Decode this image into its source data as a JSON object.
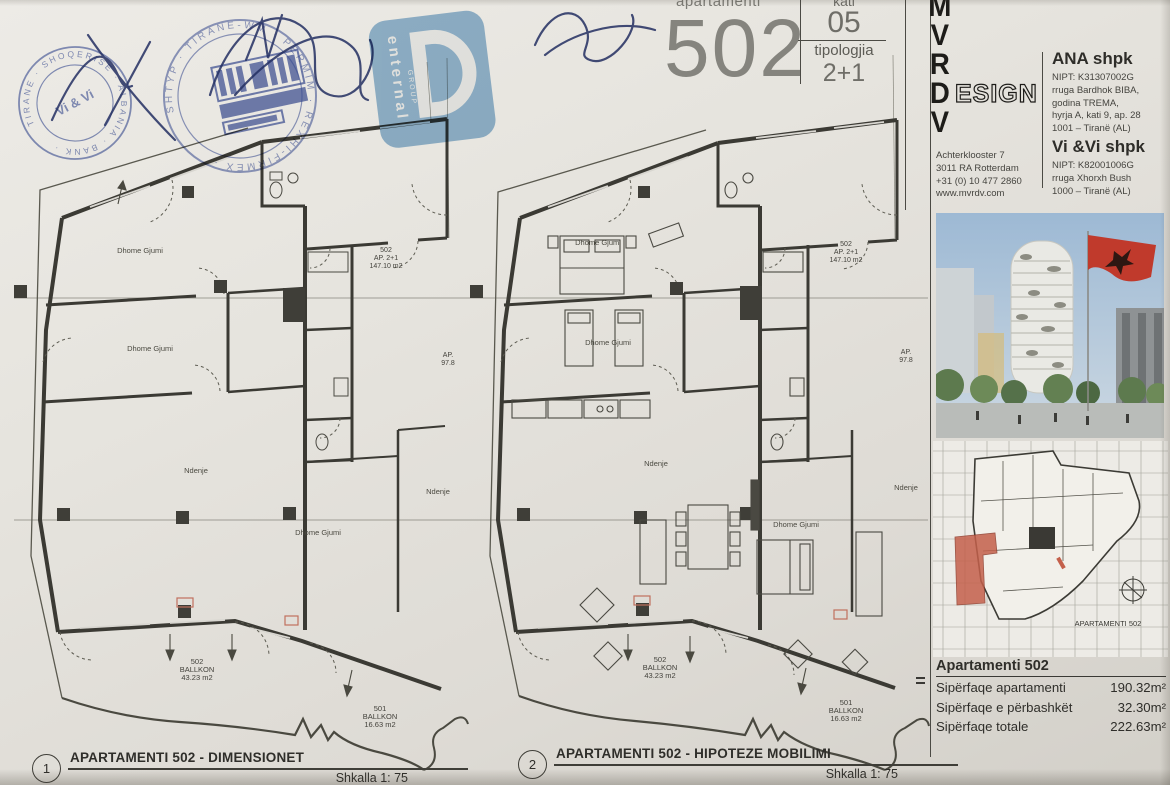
{
  "header": {
    "apartamenti_label": "apartamenti",
    "apartment_number": "502",
    "kati_label": "kati",
    "kati_value": "05",
    "tipologjia_label": "tipologjia",
    "tipologjia_value": "2+1"
  },
  "stamps": {
    "enternal_name": "enternal",
    "enternal_group": "GROUP",
    "vivi_ring_text": "TIRANE · SHOQERISE · ALBANIA · BANK ·",
    "vivi_center_text": "Vi & Vi",
    "round_ring_text": "SHTYP · TIRANE-WM · PERMIM · REXHI-FIRMEX ·"
  },
  "mvrdv": {
    "letters": [
      "M",
      "V",
      "R",
      "D",
      "V"
    ],
    "design_suffix": "ESIGN",
    "address": [
      "Achterklooster 7",
      "3011 RA Rotterdam",
      "+31 (0) 10 477 2860",
      "www.mvrdv.com"
    ]
  },
  "contacts": {
    "ana_name": "ANA shpk",
    "ana_lines": [
      "NIPT: K31307002G",
      "rruga Bardhok BIBA,",
      "godina TREMA,",
      "hyrja A, kati 9, ap. 28",
      "1001 – Tiranë (AL)"
    ],
    "vivi_name": "Vi &Vi shpk",
    "vivi_lines": [
      "NIPT: K82001006G",
      "rruga Xhorxh Bush",
      "1000 – Tiranë (AL)"
    ]
  },
  "plans": {
    "rooms": {
      "bedroom": "Dhome Gjumi",
      "living": "Ndenje"
    },
    "unit_tag": {
      "number": "502",
      "type": "AP. 2+1",
      "area": "147.10 m2"
    },
    "ap_small": {
      "label": "AP.",
      "area": "97.8"
    },
    "balcony_502": {
      "number": "502",
      "label": "BALLKON",
      "area": "43.23 m2"
    },
    "balcony_501": {
      "number": "501",
      "label": "BALLKON",
      "area": "16.63 m2"
    },
    "left": {
      "marker": "1",
      "title": "APARTAMENTI 502 - DIMENSIONET",
      "scale_label": "Shkalla 1: 75"
    },
    "right": {
      "marker": "2",
      "title": "APARTAMENTI 502 - HIPOTEZE MOBILIMI",
      "scale_label": "Shkalla 1: 75"
    }
  },
  "keyplan": {
    "caption": "APARTAMENTI 502"
  },
  "summary": {
    "title": "Apartamenti 502",
    "rows": [
      {
        "label": "Sipërfaqe apartamenti",
        "value": "190.32m²"
      },
      {
        "label": "Sipërfaqe e përbashkët",
        "value": "32.30m²"
      },
      {
        "label": "Sipërfaqe totale",
        "value": "222.63m²"
      }
    ]
  }
}
